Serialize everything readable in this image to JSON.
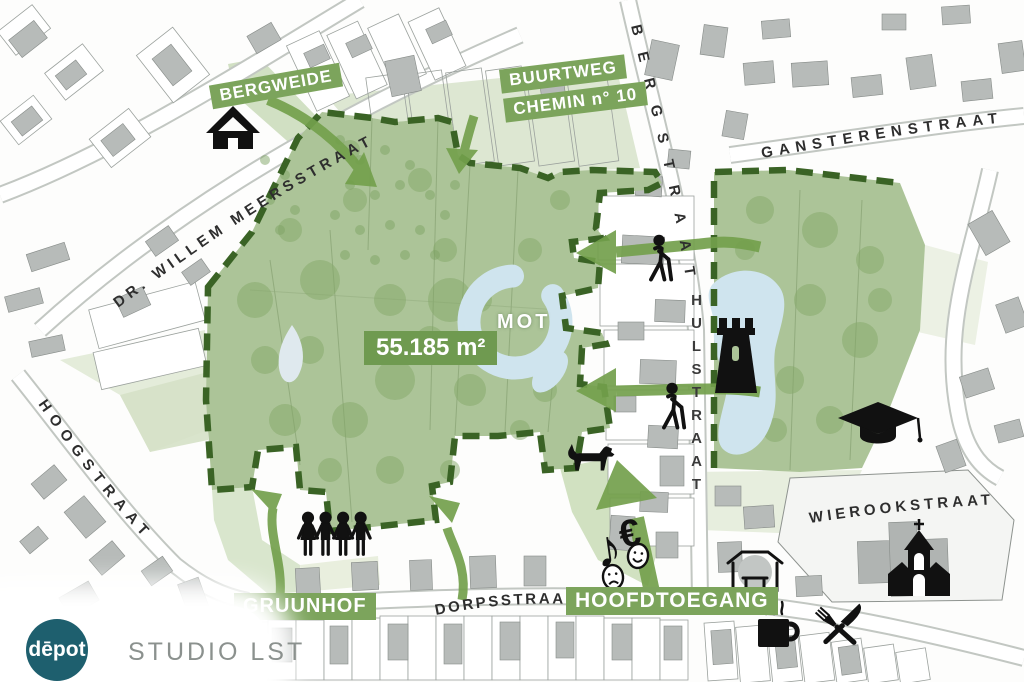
{
  "site": {
    "area_label": "55.185 m²",
    "mot_label": "MOT"
  },
  "entrances": {
    "bergweide": "BERGWEIDE",
    "buurtweg_line1": "BUURTWEG",
    "buurtweg_line2": "CHEMIN n° 10",
    "gruunhof": "GRUUNHOF",
    "hoofdtoegang": "HOOFDTOEGANG"
  },
  "streets": {
    "dr_willem_meersstraat": "DR. WILLEM MEERSSTRAAT",
    "bergstraat": "BERGSTRAAT",
    "gansterenstraat": "GANSTERENSTRAAT",
    "hoogstraat": "HOOGSTRAAT",
    "hulstraat": "HULSTRAAT",
    "wierookstraat": "WIEROOKSTRAAT",
    "dorpsstraat": "DORPSSTRAAT"
  },
  "glyphs": {
    "music_note": "♪",
    "euro": "€"
  },
  "footer": {
    "depot_logo": "dēpot",
    "studio_name": "STUDIO LST"
  },
  "colors": {
    "site_green": "#acc498",
    "light_green": "#d7e3ca",
    "tree_green": "#84a768",
    "boundary_dash": "#3a6325",
    "arrow_green": "#73a04c",
    "label_bg": "#7ca45c",
    "water_blue": "#cfe4ee",
    "building_gray": "#b7bbb9",
    "depot_teal": "#1e5f6e"
  }
}
